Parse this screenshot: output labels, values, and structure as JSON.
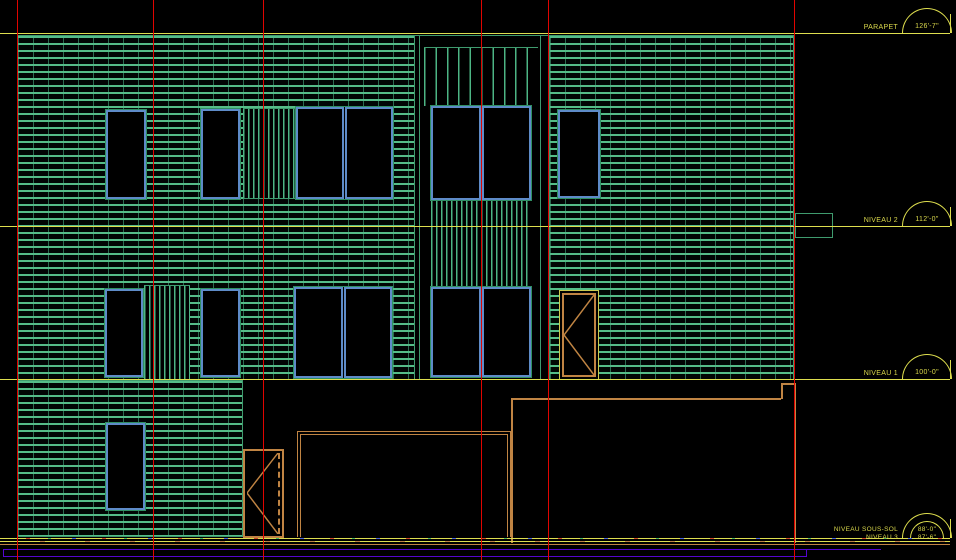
{
  "drawing": {
    "type": "architectural elevation (CAD viewport)",
    "levels": {
      "parapet": {
        "label": "PARAPET",
        "value": "126'-7\""
      },
      "niveau2": {
        "label": "NIVEAU 2",
        "value": "112'-0\""
      },
      "niveau1": {
        "label": "NIVEAU 1",
        "value": "100'-0\""
      },
      "sous_sol": {
        "label": "NIVEAU SOUS-SOL",
        "value": "88'-0\""
      },
      "niveau3": {
        "label": "NIVEAU 3",
        "value": "87'-6\""
      }
    },
    "colors": {
      "background": "#000000",
      "grid_line": "#e00400",
      "level_line": "#dede4e",
      "masonry_green": "#4db584",
      "window_frame_blue": "#5e8bc8",
      "door_tan": "#c08443",
      "site_purple": "#5506cf"
    }
  }
}
